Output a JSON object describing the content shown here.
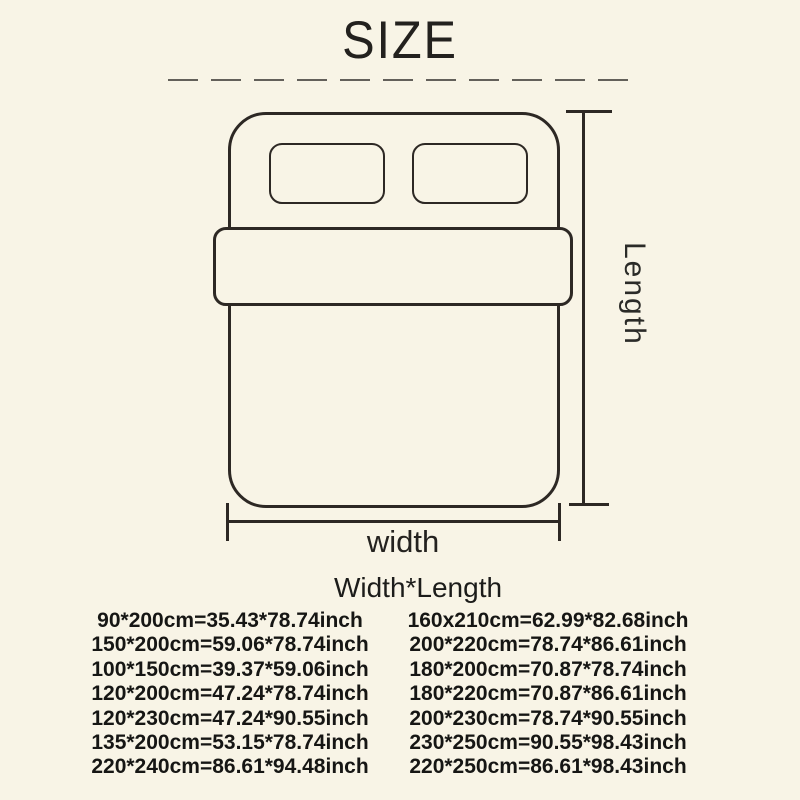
{
  "header": {
    "title": "SIZE"
  },
  "diagram": {
    "length_label": "Length",
    "width_label": "width"
  },
  "size_table": {
    "header": "Width*Length",
    "left_rows": [
      "90*200cm=35.43*78.74inch",
      "150*200cm=59.06*78.74inch",
      "100*150cm=39.37*59.06inch",
      "120*200cm=47.24*78.74inch",
      "120*230cm=47.24*90.55inch",
      "135*200cm=53.15*78.74inch",
      "220*240cm=86.61*94.48inch"
    ],
    "right_rows": [
      "160x210cm=62.99*82.68inch",
      "200*220cm=78.74*86.61inch",
      "180*200cm=70.87*78.74inch",
      "180*220cm=70.87*86.61inch",
      "200*230cm=78.74*90.55inch",
      "230*250cm=90.55*98.43inch",
      "220*250cm=86.61*98.43inch"
    ]
  },
  "colors": {
    "background": "#f8f4e6",
    "ink": "#2d2824",
    "text": "#161614",
    "divider": "#63605a"
  }
}
